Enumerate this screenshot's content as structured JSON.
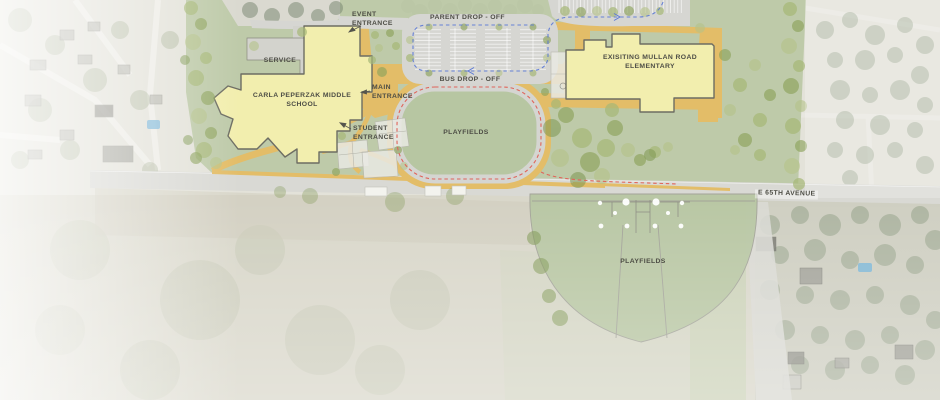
{
  "site_plan": {
    "labels": {
      "event_entrance": "EVENT ENTRANCE",
      "parent_drop_off": "PARENT DROP - OFF",
      "service": "SERVICE",
      "middle_school": "CARLA PEPERZAK MIDDLE SCHOOL",
      "main_entrance": "MAIN ENTRANCE",
      "bus_drop_off": "BUS DROP - OFF",
      "student_entrance": "STUDENT ENTRANCE",
      "elementary": "EXISITING MULLAN ROAD ELEMENTARY",
      "playfields_north": "PLAYFIELDS",
      "playfields_south": "PLAYFIELDS",
      "street": "E 65TH AVENUE"
    },
    "colors": {
      "building_fill": "#f2eeae",
      "building_outline": "#6d6d63",
      "campus_green": "#bcc8a6",
      "field_green": "#b7c6a2",
      "path_yellow": "#e3bd68",
      "road_gray": "#d9d9d4",
      "parent_route_blue": "#5b79d6",
      "bus_route_red": "#e0645a",
      "tree_green": "#9db06f"
    },
    "legend_notes": {
      "blue_dashed_route": "parent drop-off circulation",
      "red_dashed_route": "bus circulation"
    }
  }
}
